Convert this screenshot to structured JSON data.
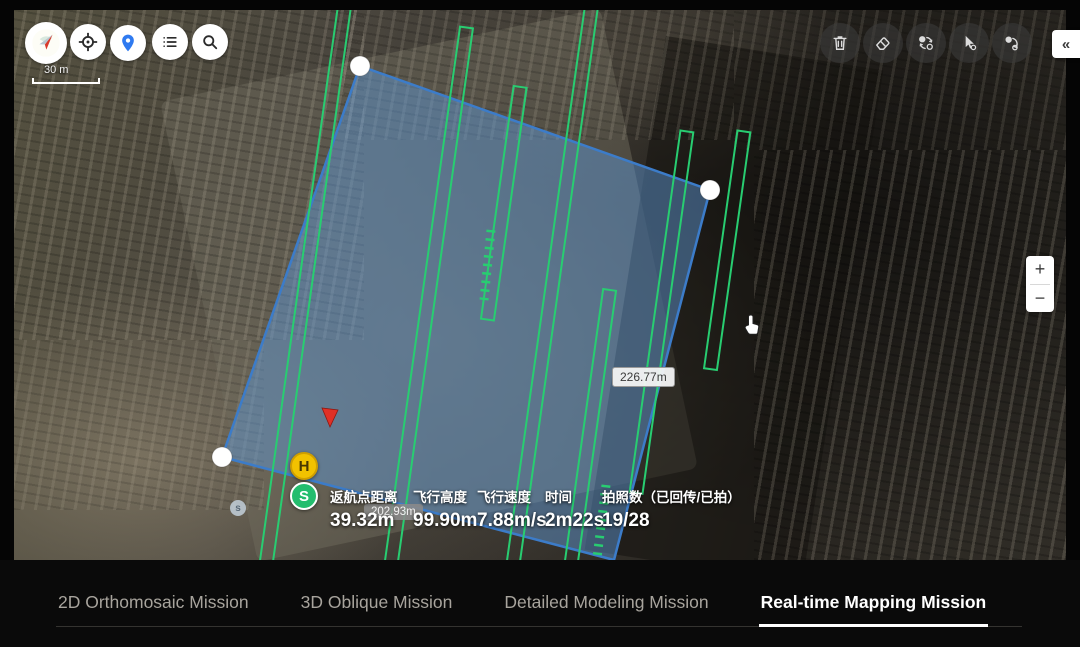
{
  "map_controls": {
    "left_buttons": [
      {
        "icon": "compass-icon"
      },
      {
        "icon": "my-location-icon"
      },
      {
        "icon": "map-pin-icon"
      },
      {
        "icon": "list-icon"
      },
      {
        "icon": "search-icon"
      }
    ],
    "right_buttons": [
      {
        "icon": "trash-icon"
      },
      {
        "icon": "eraser-icon"
      },
      {
        "icon": "swap-points-icon"
      },
      {
        "icon": "pointer-select-icon"
      },
      {
        "icon": "revert-point-icon"
      }
    ],
    "collapse_label": "«",
    "zoom_in_label": "+",
    "zoom_out_label": "−",
    "scale_label": "30 m"
  },
  "mission": {
    "edge_labels": [
      "226.77m",
      "202.93m"
    ],
    "markers": [
      {
        "label": "H",
        "meaning": "home-point"
      },
      {
        "label": "S",
        "meaning": "start-point"
      },
      {
        "label": "s",
        "meaning": "secondary-start-point"
      }
    ]
  },
  "telemetry": {
    "stats": [
      {
        "label": "返航点距离",
        "value": "39.32m"
      },
      {
        "label": "飞行高度",
        "value": "99.90m"
      },
      {
        "label": "飞行速度",
        "value": "7.88m/s"
      },
      {
        "label": "时间",
        "value": "2m22s"
      },
      {
        "label": "拍照数（已回传/已拍）",
        "value": "19/28"
      }
    ]
  },
  "tabs": [
    {
      "label": "2D Orthomosaic Mission",
      "active": false
    },
    {
      "label": "3D Oblique Mission",
      "active": false
    },
    {
      "label": "Detailed Modeling Mission",
      "active": false
    },
    {
      "label": "Real-time Mapping Mission",
      "active": true
    }
  ],
  "colors": {
    "mission_fill": "#609ad6",
    "mission_stroke": "#3c7cc9",
    "path_green": "#28cd71",
    "arrow_red": "#e03026",
    "home_gold": "#f2c200",
    "start_green": "#23bd6e",
    "tab_active": "#ffffff",
    "tab_inactive": "#a8a49d"
  }
}
